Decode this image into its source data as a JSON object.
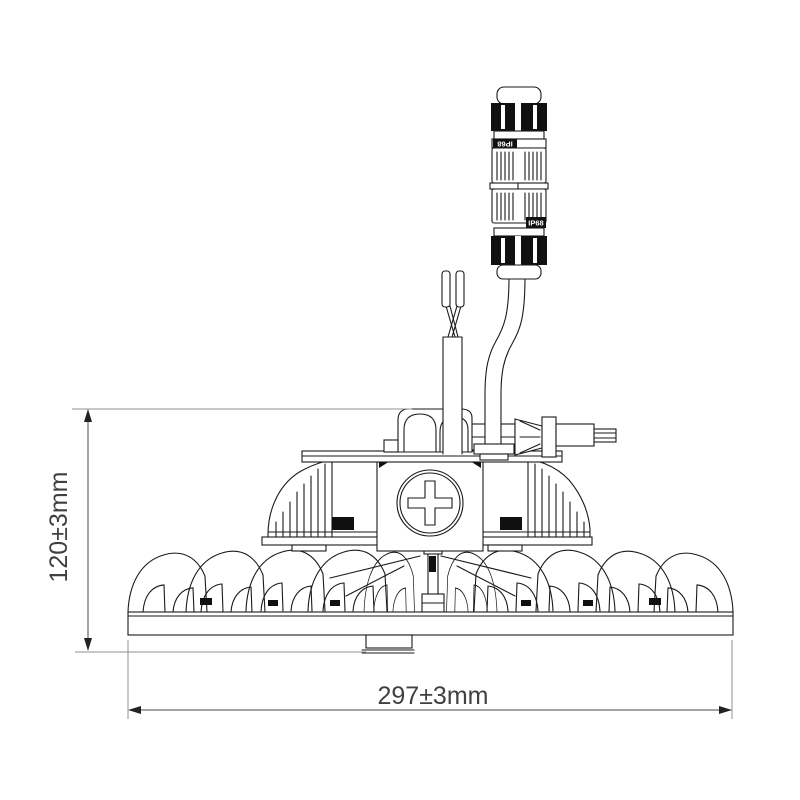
{
  "colors": {
    "background": "#ffffff",
    "drawing_line": "#1a1a1a",
    "dimension_line": "#4a4a4a",
    "extension_line": "#909090",
    "dimension_text": "#404040",
    "label_bg": "#101010",
    "label_text": "#ffffff"
  },
  "dimensions": {
    "height": {
      "label": "120±3mm"
    },
    "width": {
      "label": "297±3mm"
    }
  },
  "connector": {
    "upper_label": "IP68",
    "lower_label": "IP68"
  },
  "icons": {
    "phillips_cross": "+",
    "arrow_up": "▲",
    "arrow_down": "▼",
    "arrow_left": "◀",
    "arrow_right": "▶"
  }
}
